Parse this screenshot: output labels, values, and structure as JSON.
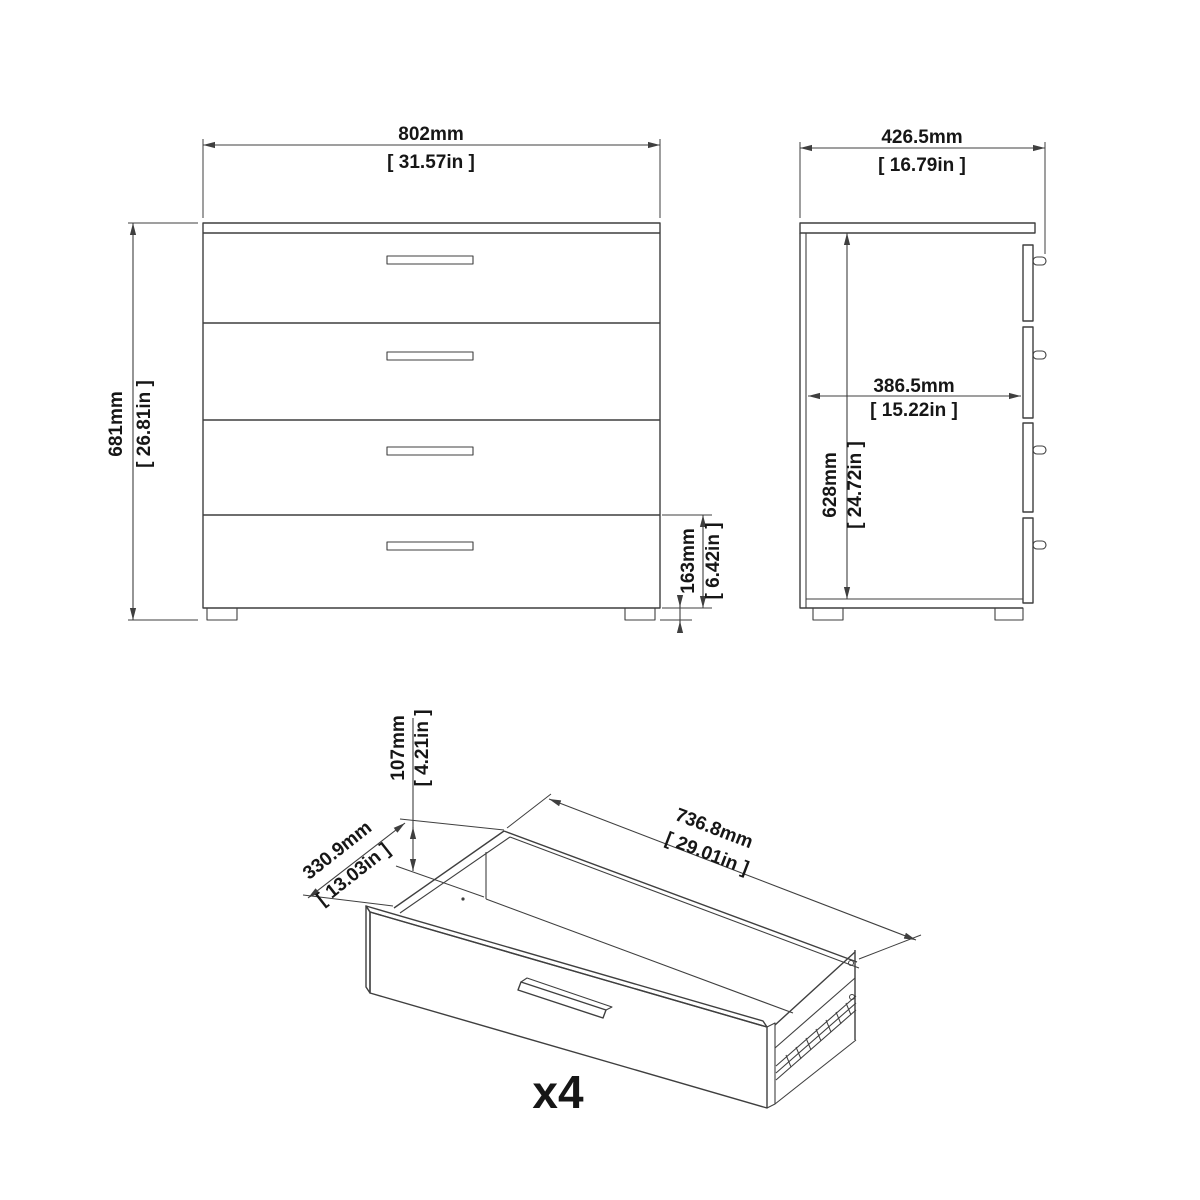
{
  "front": {
    "width_mm": "802mm",
    "width_in": "[ 31.57in ]",
    "height_mm": "681mm",
    "height_in": "[ 26.81in ]",
    "drawer_front_height_mm": "163mm",
    "drawer_front_height_in": "[ 6.42in ]",
    "foot_height_mm": "20mm",
    "foot_height_in": "[ 0.79in ]"
  },
  "side": {
    "depth_mm": "426.5mm",
    "depth_in": "[ 16.79in ]",
    "internal_depth_mm": "386.5mm",
    "internal_depth_in": "[ 15.22in ]",
    "internal_height_mm": "628mm",
    "internal_height_in": "[ 24.72in ]"
  },
  "drawer": {
    "height_mm": "107mm",
    "height_in": "[ 4.21in ]",
    "depth_mm": "330.9mm",
    "depth_in": "[ 13.03in ]",
    "width_mm": "736.8mm",
    "width_in": "[ 29.01in ]",
    "quantity": "x4"
  },
  "colors": {
    "line": "#3f3f3f",
    "text": "#161616",
    "background": "#ffffff"
  }
}
